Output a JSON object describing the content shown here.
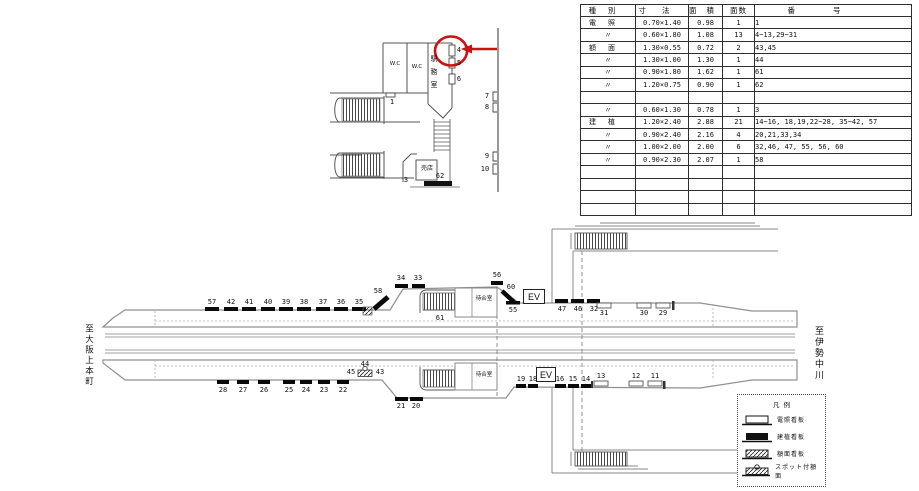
{
  "table": {
    "headers": [
      "種別",
      "寸法",
      "面積",
      "面数",
      "番号"
    ],
    "rows": [
      [
        "電照",
        "0.70×1.40",
        "0.98",
        "1",
        "1"
      ],
      [
        "〃",
        "0.60×1.80",
        "1.08",
        "13",
        "4~13,29~31"
      ],
      [
        "額面",
        "1.30×0.55",
        "0.72",
        "2",
        "43,45"
      ],
      [
        "〃",
        "1.30×1.00",
        "1.30",
        "1",
        "44"
      ],
      [
        "〃",
        "0.90×1.80",
        "1.62",
        "1",
        "61"
      ],
      [
        "〃",
        "1.20×0.75",
        "0.90",
        "1",
        "62"
      ],
      [
        "",
        "",
        "",
        "",
        ""
      ],
      [
        "〃",
        "0.60×1.30",
        "0.78",
        "1",
        "3"
      ],
      [
        "建植",
        "1.20×2.40",
        "2.88",
        "21",
        "14~16, 18,19,22~28, 35~42, 57"
      ],
      [
        "〃",
        "0.90×2.40",
        "2.16",
        "4",
        "20,21,33,34"
      ],
      [
        "〃",
        "1.00×2.00",
        "2.00",
        "6",
        "32,46, 47, 55, 56, 60"
      ],
      [
        "〃",
        "0.90×2.30",
        "2.07",
        "1",
        "58"
      ],
      [
        "",
        "",
        "",
        "",
        ""
      ],
      [
        "",
        "",
        "",
        "",
        ""
      ],
      [
        "",
        "",
        "",
        "",
        ""
      ],
      [
        "",
        "",
        "",
        "",
        ""
      ]
    ]
  },
  "concourse": {
    "wc1": "W.C",
    "wc2": "W.C",
    "office": "駅務室",
    "kiosk": "売店",
    "s1": "1",
    "s3": "3",
    "s4": "4",
    "s5": "5",
    "s6": "6",
    "s62": "62",
    "m7": "7",
    "m8": "8",
    "m9": "9",
    "m10": "10"
  },
  "plat": {
    "left_destination": "至大阪上本町",
    "right_destination": "至伊勢中川",
    "waiting_room": "待合室",
    "top": {
      "back": [
        "57",
        "42",
        "41",
        "40",
        "39",
        "38",
        "37",
        "36",
        "35"
      ],
      "diag": "58",
      "mid": [
        "34",
        "33"
      ],
      "stairs": "61",
      "corner": "56",
      "diag2": "60",
      "ev": "EV",
      "below_ev": "55",
      "right": [
        "47",
        "46",
        "32"
      ],
      "light": [
        "31",
        "30",
        "29"
      ]
    },
    "bottom": {
      "back": [
        "28",
        "27",
        "26",
        "25",
        "24",
        "23",
        "22"
      ],
      "spot": {
        "left": "45",
        "top": "44",
        "right": "43"
      },
      "low": [
        "21",
        "20"
      ],
      "pair": [
        "19",
        "18"
      ],
      "ev": "EV",
      "mid": [
        "16",
        "15",
        "14"
      ],
      "light": [
        "13",
        "12",
        "11"
      ]
    }
  },
  "legend": {
    "title": "凡例",
    "items": [
      "電照看板",
      "建植看板",
      "額面看板",
      "スポット付額面"
    ]
  },
  "colors": {
    "red": "#cc1111",
    "line": "#555555",
    "platform": "#909090",
    "track": "#a0a0a0",
    "black": "#0a0a0a"
  }
}
